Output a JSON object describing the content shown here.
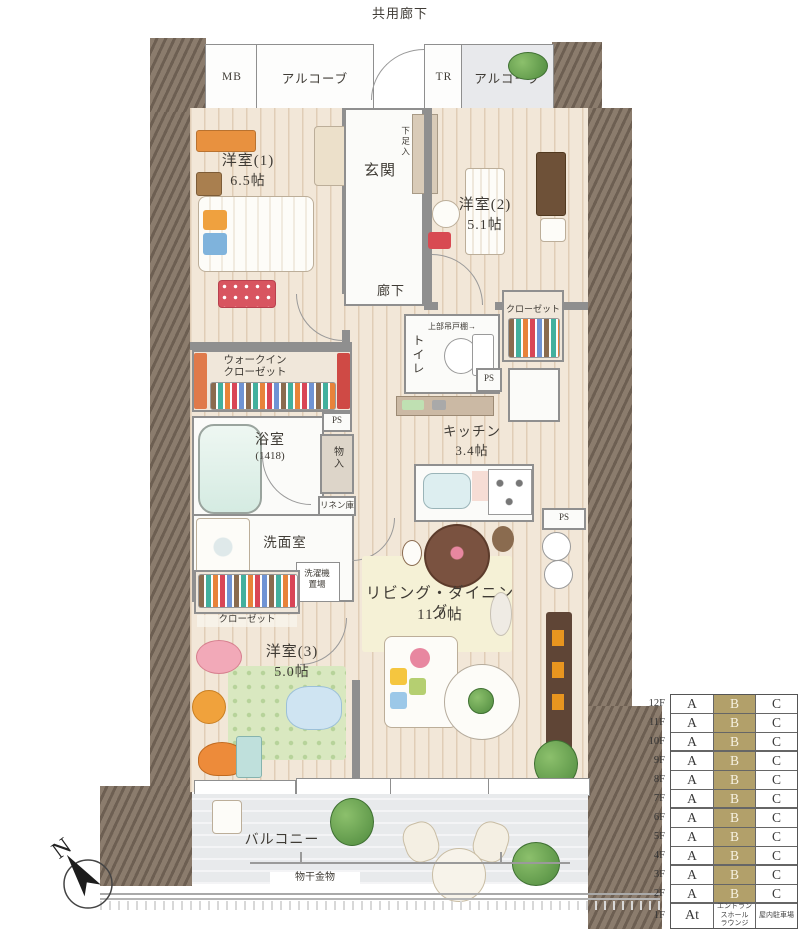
{
  "plan": {
    "corridor_label": "共用廊下",
    "top_band": {
      "mb": "MB",
      "alcove_left": "アルコーブ",
      "tr": "TR",
      "alcove_right": "アルコーブ"
    },
    "entrance": {
      "name": "玄関",
      "shoe_cabinet": "下足入"
    },
    "rooms": {
      "western1_name": "洋室(1)",
      "western1_size": "6.5帖",
      "western2_name": "洋室(2)",
      "western2_size": "5.1帖",
      "western3_name": "洋室(3)",
      "western3_size": "5.0帖",
      "living_name": "リビング・ダイニング",
      "living_size": "11.0帖",
      "kitchen_name": "キッチン",
      "kitchen_size": "3.4帖",
      "bath_name": "浴室",
      "bath_size": "(1418)",
      "washroom_name": "洗面室",
      "hallway_name": "廊下",
      "toilet_name": "トイレ",
      "toilet_shelf_note": "上部吊戸棚→",
      "closet": "クローゼット",
      "wic_line1": "ウォークイン",
      "wic_line2": "クローゼット",
      "storage": "物入",
      "linen": "リネン庫",
      "laundry_line1": "洗濯機",
      "laundry_line2": "置場",
      "ps": "PS"
    },
    "balcony": {
      "name": "バルコニー",
      "drying_hardware": "物干金物"
    }
  },
  "compass": {
    "north": "N"
  },
  "colors": {
    "highlight": "#b2a06a",
    "wall": "#7c6d60",
    "wood": "#f2e7d8"
  },
  "floor_table": {
    "columns": [
      "A",
      "B",
      "C"
    ],
    "highlight_color": "#b2a06a",
    "rows": [
      {
        "floor": "12F",
        "cells": [
          {
            "t": "A"
          },
          {
            "t": "B",
            "hl": true
          },
          {
            "t": "C"
          }
        ]
      },
      {
        "floor": "11F",
        "cells": [
          {
            "t": "A"
          },
          {
            "t": "B",
            "hl": true
          },
          {
            "t": "C"
          }
        ]
      },
      {
        "floor": "10F",
        "thick": true,
        "cells": [
          {
            "t": "A"
          },
          {
            "t": "B",
            "hl": true
          },
          {
            "t": "C"
          }
        ]
      },
      {
        "floor": "9F",
        "cells": [
          {
            "t": "A"
          },
          {
            "t": "B",
            "hl": true
          },
          {
            "t": "C"
          }
        ]
      },
      {
        "floor": "8F",
        "cells": [
          {
            "t": "A"
          },
          {
            "t": "B",
            "hl": true
          },
          {
            "t": "C"
          }
        ]
      },
      {
        "floor": "7F",
        "thick": true,
        "cells": [
          {
            "t": "A"
          },
          {
            "t": "B",
            "hl": true
          },
          {
            "t": "C"
          }
        ]
      },
      {
        "floor": "6F",
        "cells": [
          {
            "t": "A"
          },
          {
            "t": "B",
            "hl": true
          },
          {
            "t": "C"
          }
        ]
      },
      {
        "floor": "5F",
        "cells": [
          {
            "t": "A"
          },
          {
            "t": "B",
            "hl": true
          },
          {
            "t": "C"
          }
        ]
      },
      {
        "floor": "4F",
        "thick": true,
        "cells": [
          {
            "t": "A"
          },
          {
            "t": "B",
            "hl": true
          },
          {
            "t": "C"
          }
        ]
      },
      {
        "floor": "3F",
        "cells": [
          {
            "t": "A"
          },
          {
            "t": "B",
            "hl": true
          },
          {
            "t": "C"
          }
        ]
      },
      {
        "floor": "2F",
        "thick": true,
        "cells": [
          {
            "t": "A"
          },
          {
            "t": "B",
            "hl": true
          },
          {
            "t": "C"
          }
        ]
      },
      {
        "floor": "1F",
        "tall": true,
        "cells": [
          {
            "t": "At",
            "cls": "at"
          },
          {
            "t": "エントランスホール\nラウンジ",
            "small": true
          },
          {
            "t": "屋内駐車場",
            "small": true
          }
        ]
      }
    ]
  }
}
